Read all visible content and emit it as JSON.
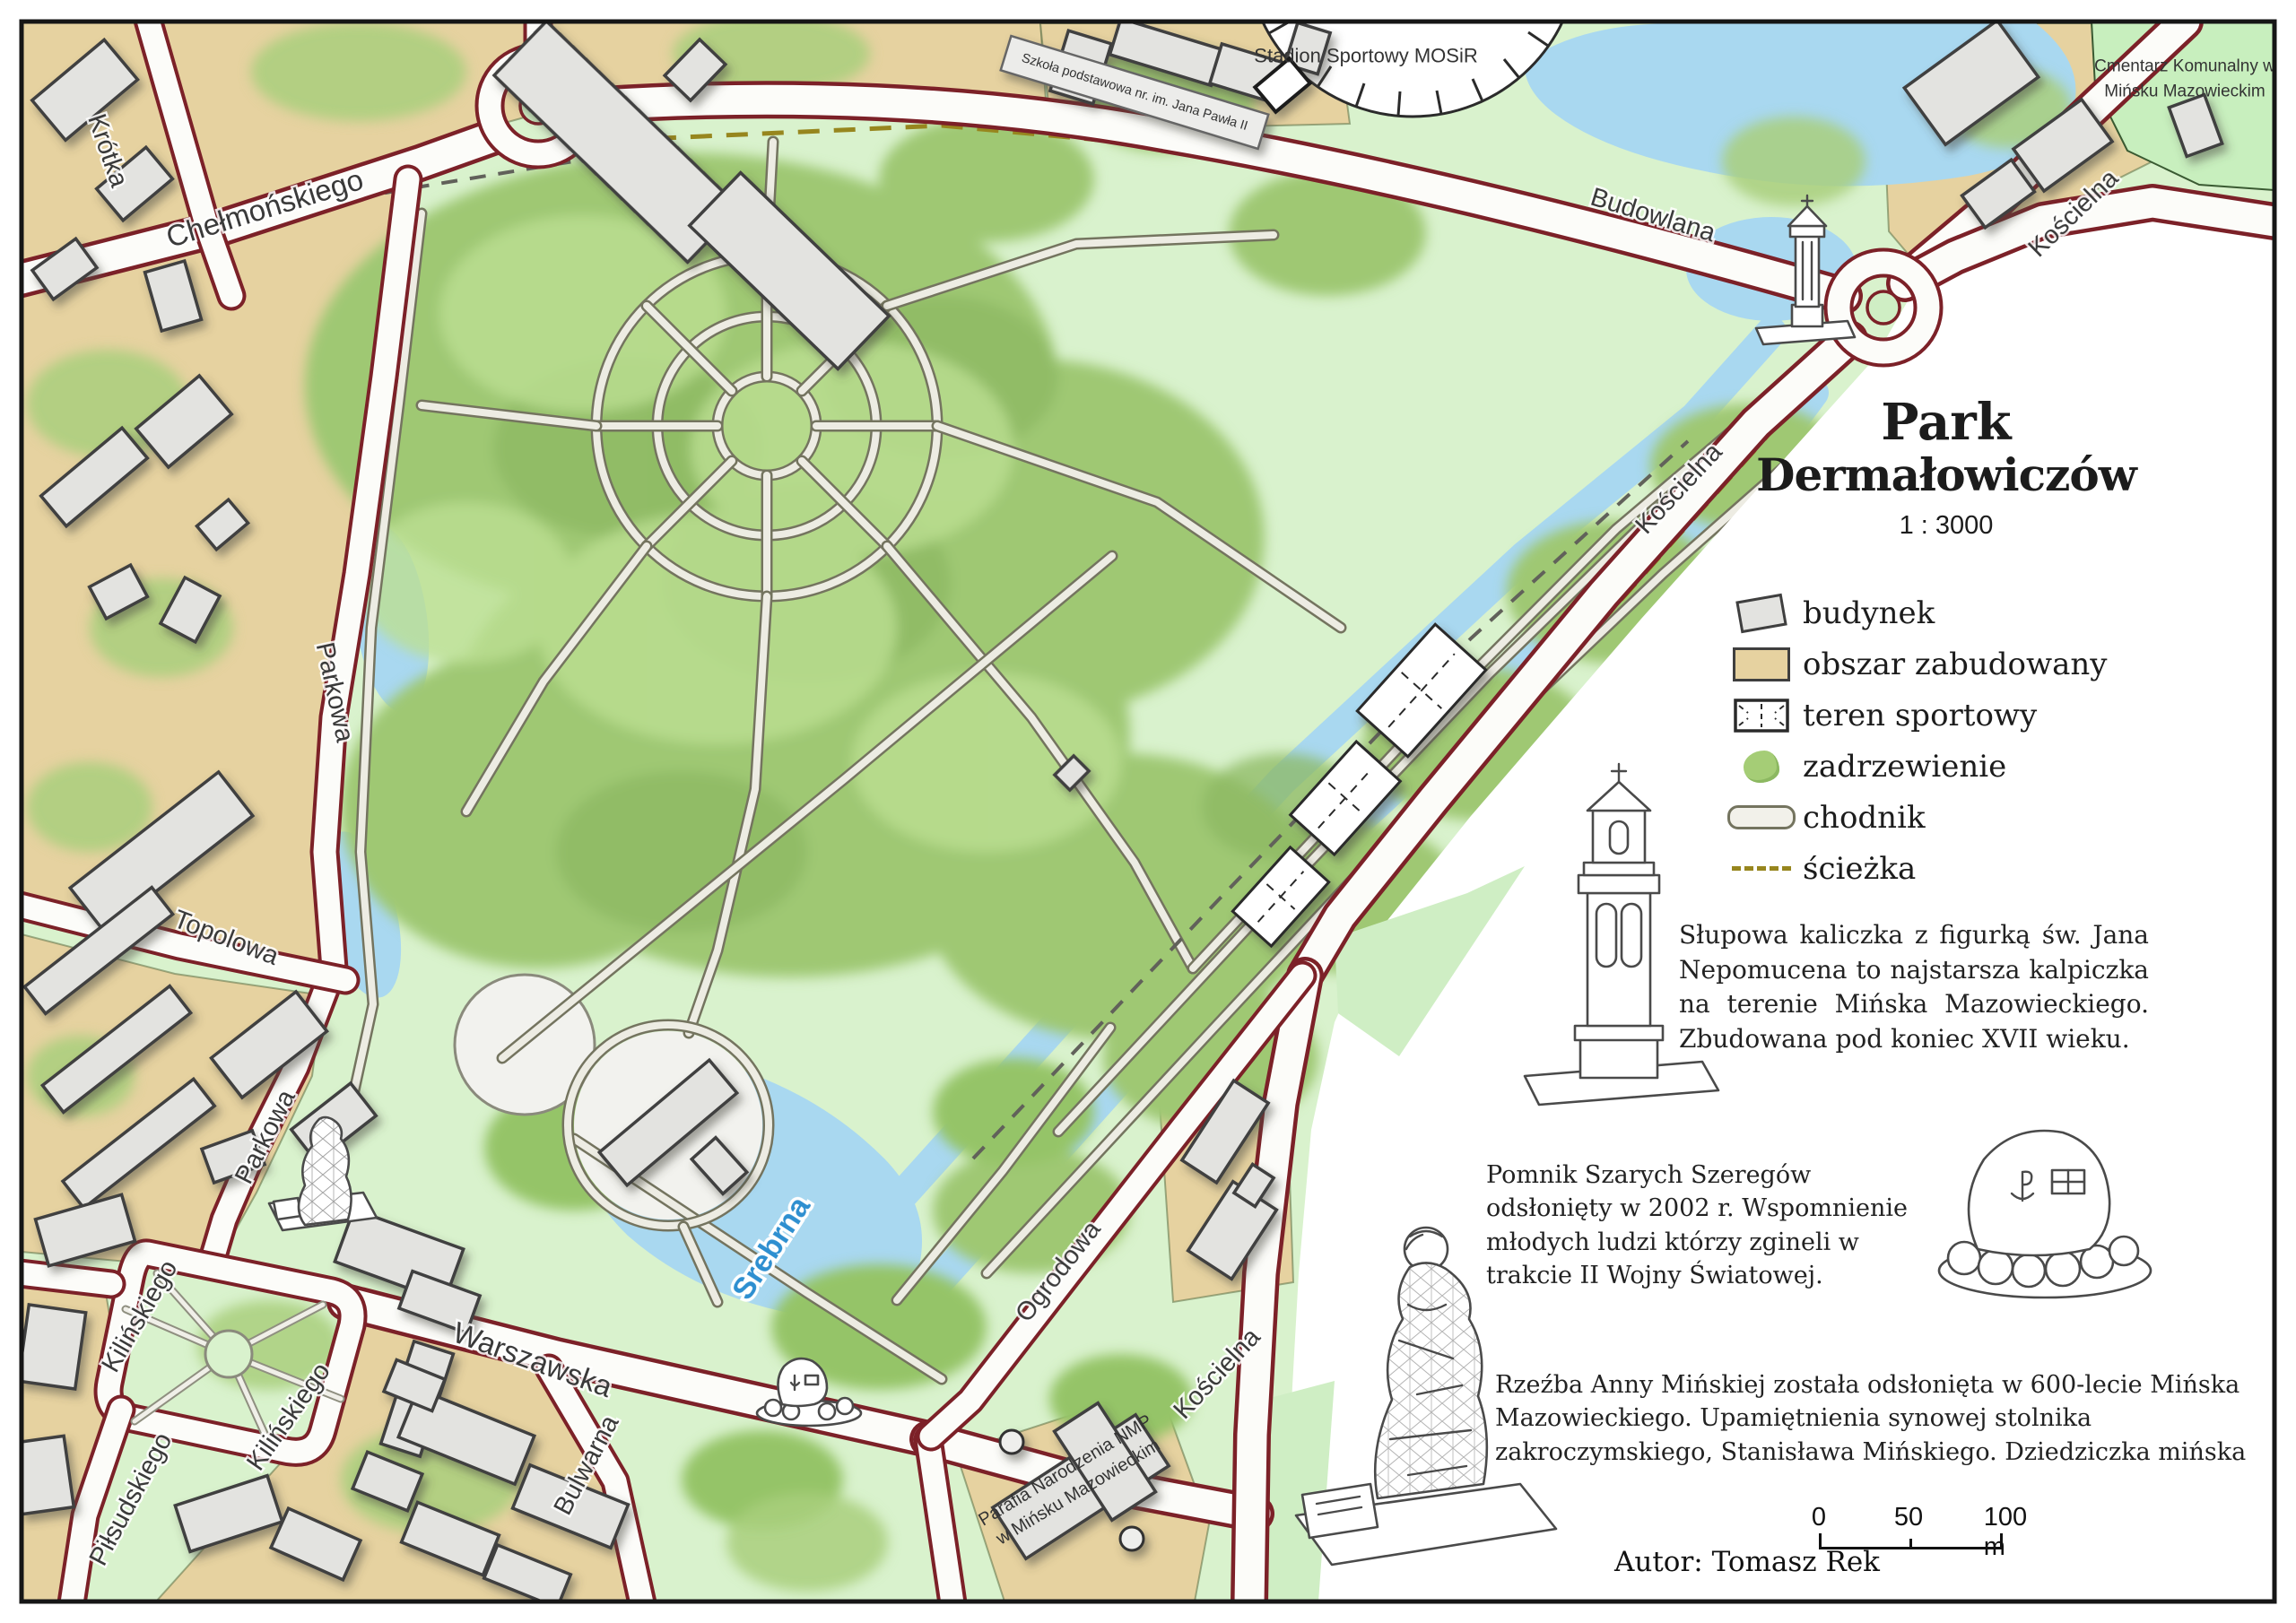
{
  "title": {
    "line1": "Park",
    "line2": "Dermałowiczów",
    "scale_text": "1 : 3000"
  },
  "legend": {
    "items": [
      {
        "label": "budynek"
      },
      {
        "label": "obszar zabudowany"
      },
      {
        "label": "teren sportowy"
      },
      {
        "label": "zadrzewienie"
      },
      {
        "label": "chodnik"
      },
      {
        "label": "ścieżka"
      }
    ]
  },
  "annotations": {
    "kapliczka_text": "Słupowa kaliczka z figurką św. Jana Nepomucena to najstarsza kalpiczka na terenie Mińska Mazowieckiego. Zbudowana pod koniec XVII wieku.",
    "pomnik_text": "Pomnik Szarych Szeregów odsłonięty w 2002 r. Wspomnienie młodych ludzi którzy zgineli w trakcie II Wojny Światowej.",
    "rzezba_text": "Rzeźba Anny Mińskiej została odsłonięta w 600-lecie Mińska Mazowieckiego. Upamiętnienia synowej stolnika zakroczymskiego, Stanisława Mińskiego. Dziedziczka mińska"
  },
  "footer": {
    "author": "Autor: Tomasz Rek"
  },
  "scalebar": {
    "zero": "0",
    "fifty": "50",
    "hundred": "100 m"
  },
  "map_labels": {
    "streets": {
      "krotka": "Krótka",
      "chelmonskiego": "Chełmońskiego",
      "parkowa": "Parkowa",
      "topolowa": "Topolowa",
      "kilinskiego": "Kilińskiego",
      "pilsudskiego": "Piłsudskiego",
      "warszawska": "Warszawska",
      "bulwarna": "Bulwarna",
      "ogrodowa": "Ogrodowa",
      "koscielna": "Kościelna",
      "budowlana": "Budowlana"
    },
    "river": "Srebrna",
    "pois": {
      "stadion": "Stadion Sportowy MOSiR",
      "szkola": "Szkoła podstawowa nr. im. Jana Pawła II",
      "cmentarz_line1": "Cmentarz Komunalny w",
      "cmentarz_line2": "Mińsku Mazowieckim",
      "parafia_line1": "Parafia Narodzenia NMP",
      "parafia_line2": "w Mińsku Mazowieckim"
    }
  },
  "colors": {
    "road_edge": "#7c2128",
    "built_up": "#e6d2a0",
    "water": "#a9d8f0",
    "tree_green": "#a3cb76",
    "open_green": "#d9f2cd",
    "building_fill": "#e3e3e0",
    "path_dashed": "#97861e"
  }
}
